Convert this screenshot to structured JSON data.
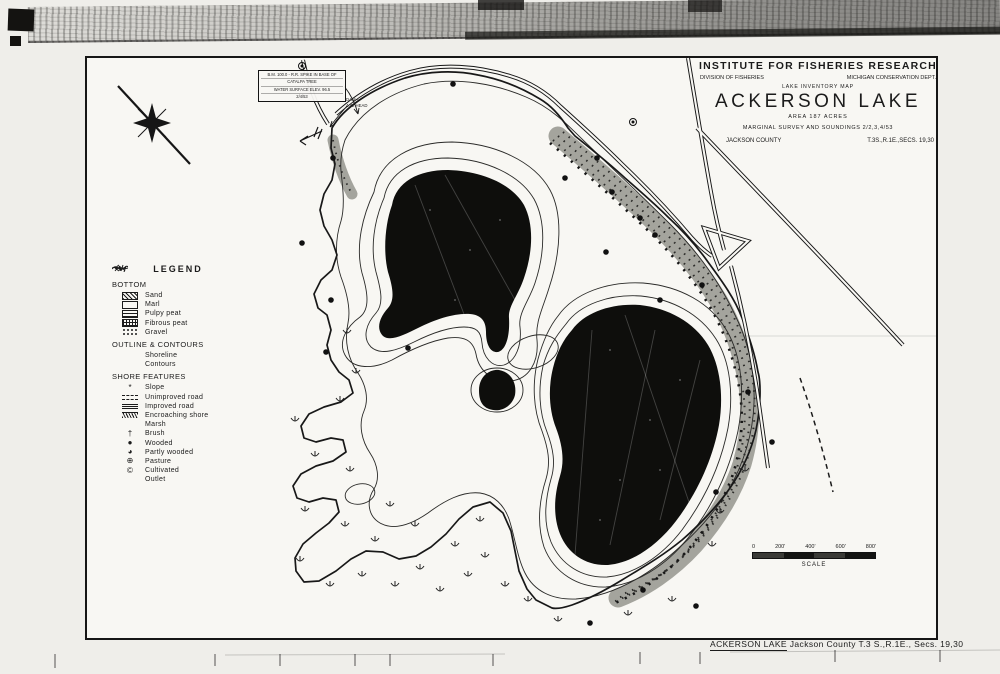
{
  "title_block": {
    "institute": "INSTITUTE FOR FISHERIES RESEARCH",
    "division": "DIVISION OF FISHERIES",
    "department": "MICHIGAN CONSERVATION DEPT.",
    "map_type": "LAKE INVENTORY MAP",
    "lake_name": "ACKERSON LAKE",
    "area": "AREA 187 ACRES",
    "survey": "MARGINAL SURVEY AND SOUNDINGS 2/2,3,4/53",
    "county": "JACKSON COUNTY",
    "township": "T.3S.,R.1E.,SECS. 19,30"
  },
  "legend": {
    "title": "LEGEND",
    "sections": [
      {
        "heading": "BOTTOM",
        "items": [
          {
            "label": "Sand",
            "symbol": "sand-swatch"
          },
          {
            "label": "Marl",
            "symbol": "marl-swatch"
          },
          {
            "label": "Pulpy peat",
            "symbol": "pulpy-peat-swatch"
          },
          {
            "label": "Fibrous peat",
            "symbol": "fibrous-peat-swatch"
          },
          {
            "label": "Gravel",
            "symbol": "gravel-swatch"
          }
        ]
      },
      {
        "heading": "OUTLINE & CONTOURS",
        "items": [
          {
            "label": "Shoreline",
            "symbol": "shoreline-line"
          },
          {
            "label": "Contours",
            "symbol": "contour-line"
          }
        ]
      },
      {
        "heading": "SHORE FEATURES",
        "items": [
          {
            "label": "Slope",
            "symbol": "slope-mark",
            "glyph": "*"
          },
          {
            "label": "Unimproved road",
            "symbol": "unimproved-road-line"
          },
          {
            "label": "Improved road",
            "symbol": "improved-road-line"
          },
          {
            "label": "Encroaching shore",
            "symbol": "encroaching-shore-band"
          },
          {
            "label": "Marsh",
            "symbol": "marsh-tuft"
          },
          {
            "label": "Brush",
            "symbol": "brush-mark",
            "glyph": "†"
          },
          {
            "label": "Wooded",
            "symbol": "wooded-dot",
            "glyph": "●"
          },
          {
            "label": "Partly wooded",
            "symbol": "partly-wooded-dot",
            "glyph": "◕"
          },
          {
            "label": "Pasture",
            "symbol": "pasture-ring",
            "glyph": "⊕"
          },
          {
            "label": "Cultivated",
            "symbol": "cultivated-ring",
            "glyph": "©"
          },
          {
            "label": "Outlet",
            "symbol": "outlet-arrow"
          }
        ]
      }
    ]
  },
  "annotations": {
    "benchmark": {
      "line1": "B.M. 100.0 - R.R. SPIKE IN BASE OF",
      "line2": "CATALPA TREE",
      "line3": "WATER SURFACE ELEV. 96.5",
      "line4": "2/4/53"
    },
    "dam": {
      "line1": "DAM—",
      "line2": "4.42 HEAD"
    }
  },
  "scale_bar": {
    "labels": [
      "0",
      "200'",
      "400'",
      "600'",
      "800'"
    ],
    "caption": "SCALE"
  },
  "footer": {
    "lake_name": "ACKERSON LAKE",
    "rest": " Jackson County T.3 S.,R.1E., Secs. 19,30"
  },
  "colors": {
    "ink": "#1b1b1b",
    "paper": "#f8f7f3",
    "marsh_gray": "#95958d",
    "basin_black": "#0e0e0c"
  }
}
